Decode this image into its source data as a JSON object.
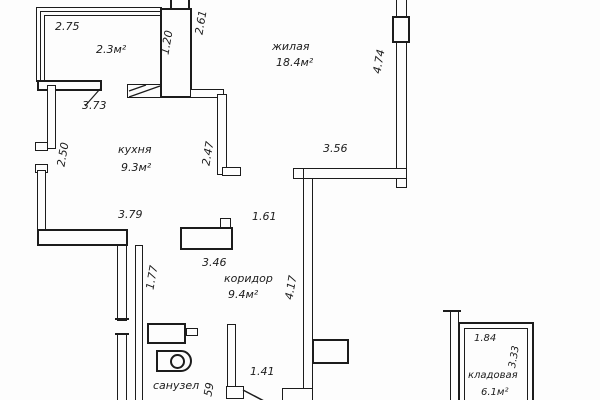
{
  "title": "apartment-floor-plan",
  "colors": {
    "line": "#1c1c1c",
    "background": "#fdfdfd"
  },
  "rooms": {
    "balcony": {
      "area": "2.3м²"
    },
    "living": {
      "name": "жилая",
      "area": "18.4м²"
    },
    "kitchen": {
      "name": "кухня",
      "area": "9.3м²"
    },
    "corridor": {
      "name": "коридор",
      "area": "9.4м²"
    },
    "bathroom": {
      "name": "санузел"
    },
    "storage": {
      "name": "кладовая",
      "area": "6.1м²"
    }
  },
  "dims": {
    "balcony_width": "2.75",
    "column_width": "1.20",
    "living_top_side": "2.61",
    "living_right_side": "4.74",
    "kitchen_top": "3.73",
    "kitchen_left": "2.50",
    "kitchen_right": "2.47",
    "living_bottom": "3.56",
    "kitchen_bottom": "3.79",
    "corridor_top": "1.61",
    "corridor_wall": "3.46",
    "corridor_left": "1.77",
    "corridor_right": "4.17",
    "entry_width": "1.41",
    "entry_small": "59",
    "storage_top": "1.84",
    "storage_right": "3.33"
  }
}
